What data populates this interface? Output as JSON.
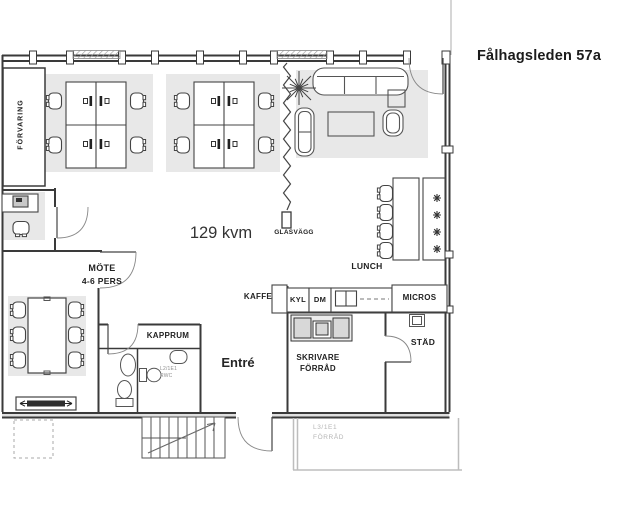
{
  "header": {
    "title": "Fålhagsleden 57a"
  },
  "plan": {
    "area_label": "129 kvm",
    "labels": {
      "forvaring": "FÖRVARING",
      "mote": "MÖTE",
      "mote_capacity": "4-6 PERS",
      "kapprum": "KAPPRUM",
      "entre": "Entré",
      "glasvagg": "GLASVÄGG",
      "lunch": "LUNCH",
      "kaffe": "KAFFE",
      "kyl": "KYL",
      "dm": "DM",
      "micros": "MICROS",
      "skrivare": "SKRIVARE",
      "skrivare_forrad": "FÖRRÅD",
      "stad": "STÄD",
      "rwc_code": "L2/1E1",
      "rwc": "RWC",
      "storage_code": "L3/1E1",
      "storage": "FÖRRÅD"
    },
    "colors": {
      "wall": "#3a3a3a",
      "furniture_line": "#555555",
      "mat": "#e8e8e8",
      "light_gray_wall": "#bdbdbd",
      "background": "#ffffff"
    }
  }
}
